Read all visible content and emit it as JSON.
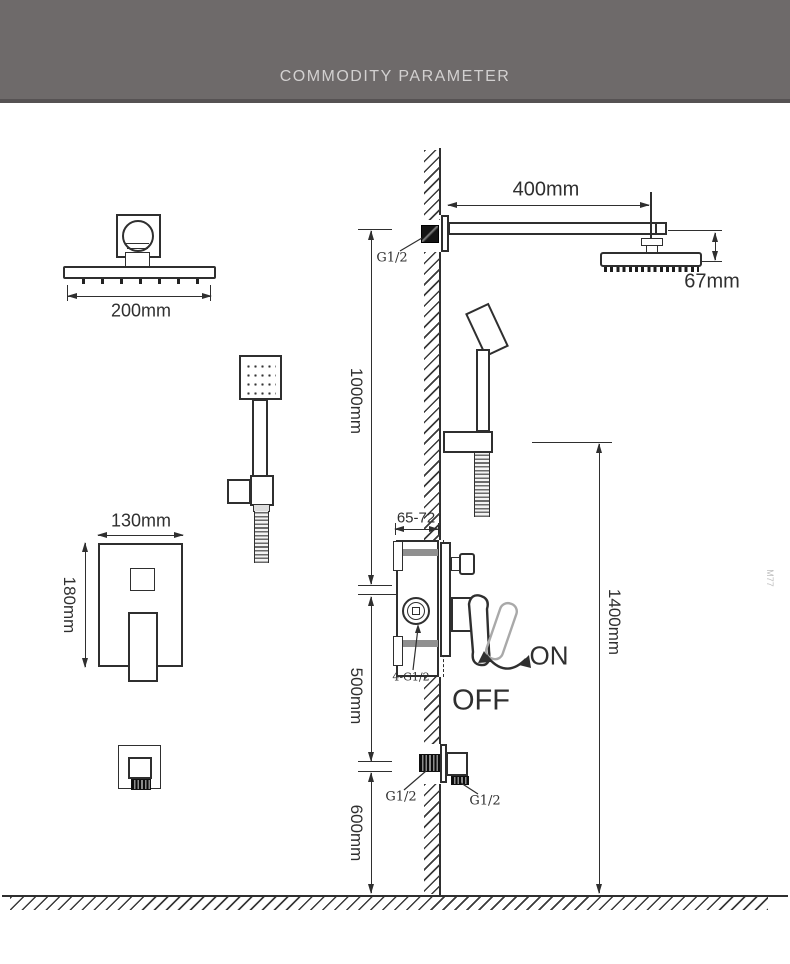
{
  "header": {
    "title": "COMMODITY PARAMETER"
  },
  "colors": {
    "header_bg": "#6e6a6a",
    "header_edge": "#565253",
    "header_text": "#d2d0d0",
    "line_ink": "#2f2f2f",
    "alt_lever_gray": "#a9a9a9"
  },
  "dimensions": {
    "arm_length": "400mm",
    "rain_head_width": "200mm",
    "rain_head_height": "67mm",
    "arm_to_valve": "1000mm",
    "valve_to_outlet": "500mm",
    "outlet_to_floor": "600mm",
    "outlet_height": "1400mm",
    "valve_recess_depth": "65-72",
    "mixer_plate_width": "130mm",
    "mixer_plate_height": "180mm"
  },
  "threads": {
    "arm_inlet": "G1/2",
    "valve_ports": "4-G1/2",
    "outlet_wall": "G1/2",
    "outlet_spout": "G1/2"
  },
  "switch": {
    "on": "ON",
    "off": "OFF"
  },
  "watermark": "M77"
}
